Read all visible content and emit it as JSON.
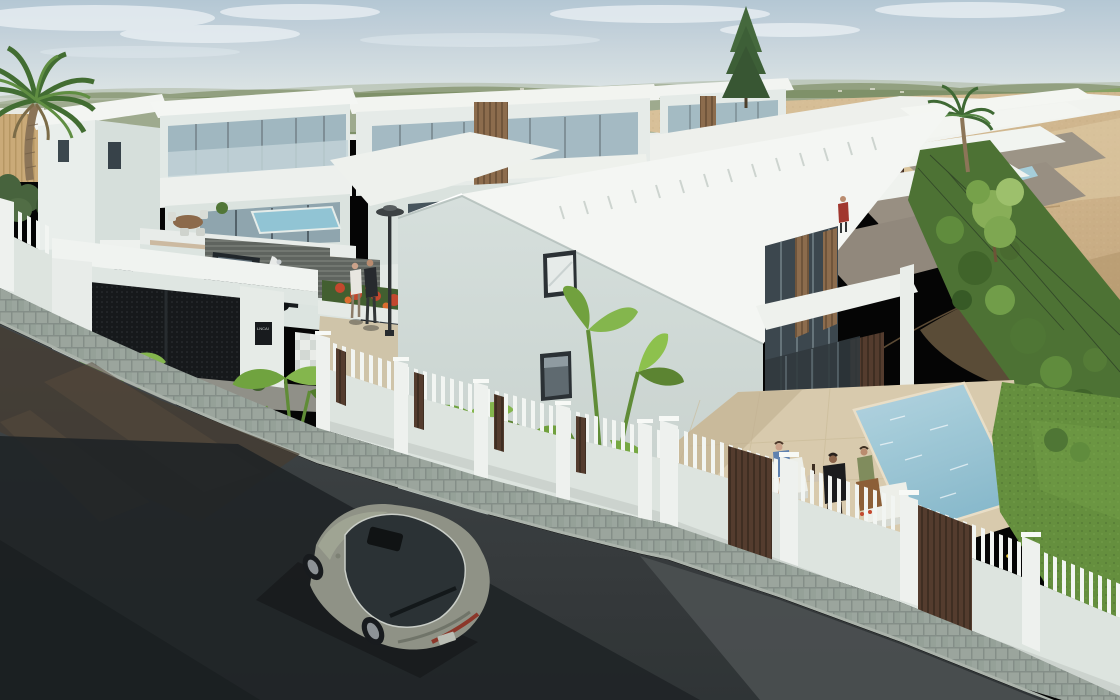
{
  "scene": {
    "type": "3d-architectural-render",
    "description": "Aerial-eye view of a modern white villa and terraced-townhouse development along a curving downhill street, beside undeveloped sandy land with green forested hills on the horizon.",
    "sky": {
      "condition": "hazy pale blue with thin soft clouds"
    },
    "terrain": {
      "horizon": "forested green hills",
      "right_side": "open sandy ground with dune ridges",
      "street": "dark asphalt in deep shadow, cobblestone sidewalk"
    },
    "development": {
      "style": "modern flat-roof white villas with glass balustrades and wood-slat screens",
      "left_villas": 3,
      "background_villas": 2,
      "townhouse_terraces": 4,
      "pools": 4,
      "features": [
        "white picket fence on masonry wall with pillars",
        "brown wood-slat fence panels",
        "entrance gate with dark perforated panels and canopy",
        "street lamp",
        "checkered driveway paving",
        "roller garage doors",
        "poolside terrace with ottomans",
        "rear gardens with mesh fence toward the sand"
      ]
    },
    "gate_plaque": {
      "text": "LNCAI"
    },
    "vehicles": [
      {
        "type": "sedan",
        "color": "olive-gray",
        "location": "driving on street"
      },
      {
        "type": "sedan",
        "color": "dark navy",
        "location": "parked in driveway"
      },
      {
        "type": "coupe",
        "color": "dark red",
        "location": "parked in driveway"
      },
      {
        "type": "pickup-truck",
        "color": "black",
        "location": "parked at garage"
      },
      {
        "type": "scooter",
        "color": "white",
        "location": "parked at garage"
      }
    ],
    "people": [
      {
        "pose": "sitting on ottoman",
        "clothing": "blue dress",
        "location": "poolside terrace"
      },
      {
        "pose": "sitting",
        "clothing": "black t-shirt",
        "location": "poolside terrace"
      },
      {
        "pose": "sitting on ottoman",
        "clothing": "green top and tan skirt",
        "location": "poolside terrace"
      },
      {
        "pose": "walking",
        "clothing": "white top",
        "location": "driveway walkway"
      },
      {
        "pose": "walking",
        "clothing": "dark outfit",
        "location": "driveway walkway"
      },
      {
        "pose": "standing on balcony",
        "clothing": "red shirt",
        "location": "townhouse terrace"
      }
    ],
    "vegetation": [
      "canary palm in foreground left",
      "banana plants draping over the street fence",
      "tall conifer behind the roofs",
      "palm and young trees in rear gardens",
      "lawn with yellow flowers",
      "red and orange flowering shrubs at the gate"
    ],
    "palette": {
      "sky_top": "#b3c6d4",
      "sky_horizon": "#eceeea",
      "hills": "#7d8f66",
      "meadow": "#85a161",
      "sand": "#d2b88f",
      "sand_shadow": "#a98e66",
      "wall_white": "#eef1ee",
      "wall_shade": "#cfd8d5",
      "roof_white": "#f4f6f3",
      "glass": "#9fb6bf",
      "glass_dark": "#39444b",
      "wood_slat": "#5a4330",
      "wood_light": "#8a6a4a",
      "fence_wall": "#dde4df",
      "picket": "#f2f5f2",
      "road": "#3a3f41",
      "road_shadow": "#1c2022",
      "cobble": "#97a29a",
      "pool": "#9ec9d8",
      "lawn": "#628d3b",
      "terrace": "#d8c9ac",
      "car_gray": "#8d9084",
      "car_red": "#571a1e",
      "car_black": "#171d22"
    }
  }
}
